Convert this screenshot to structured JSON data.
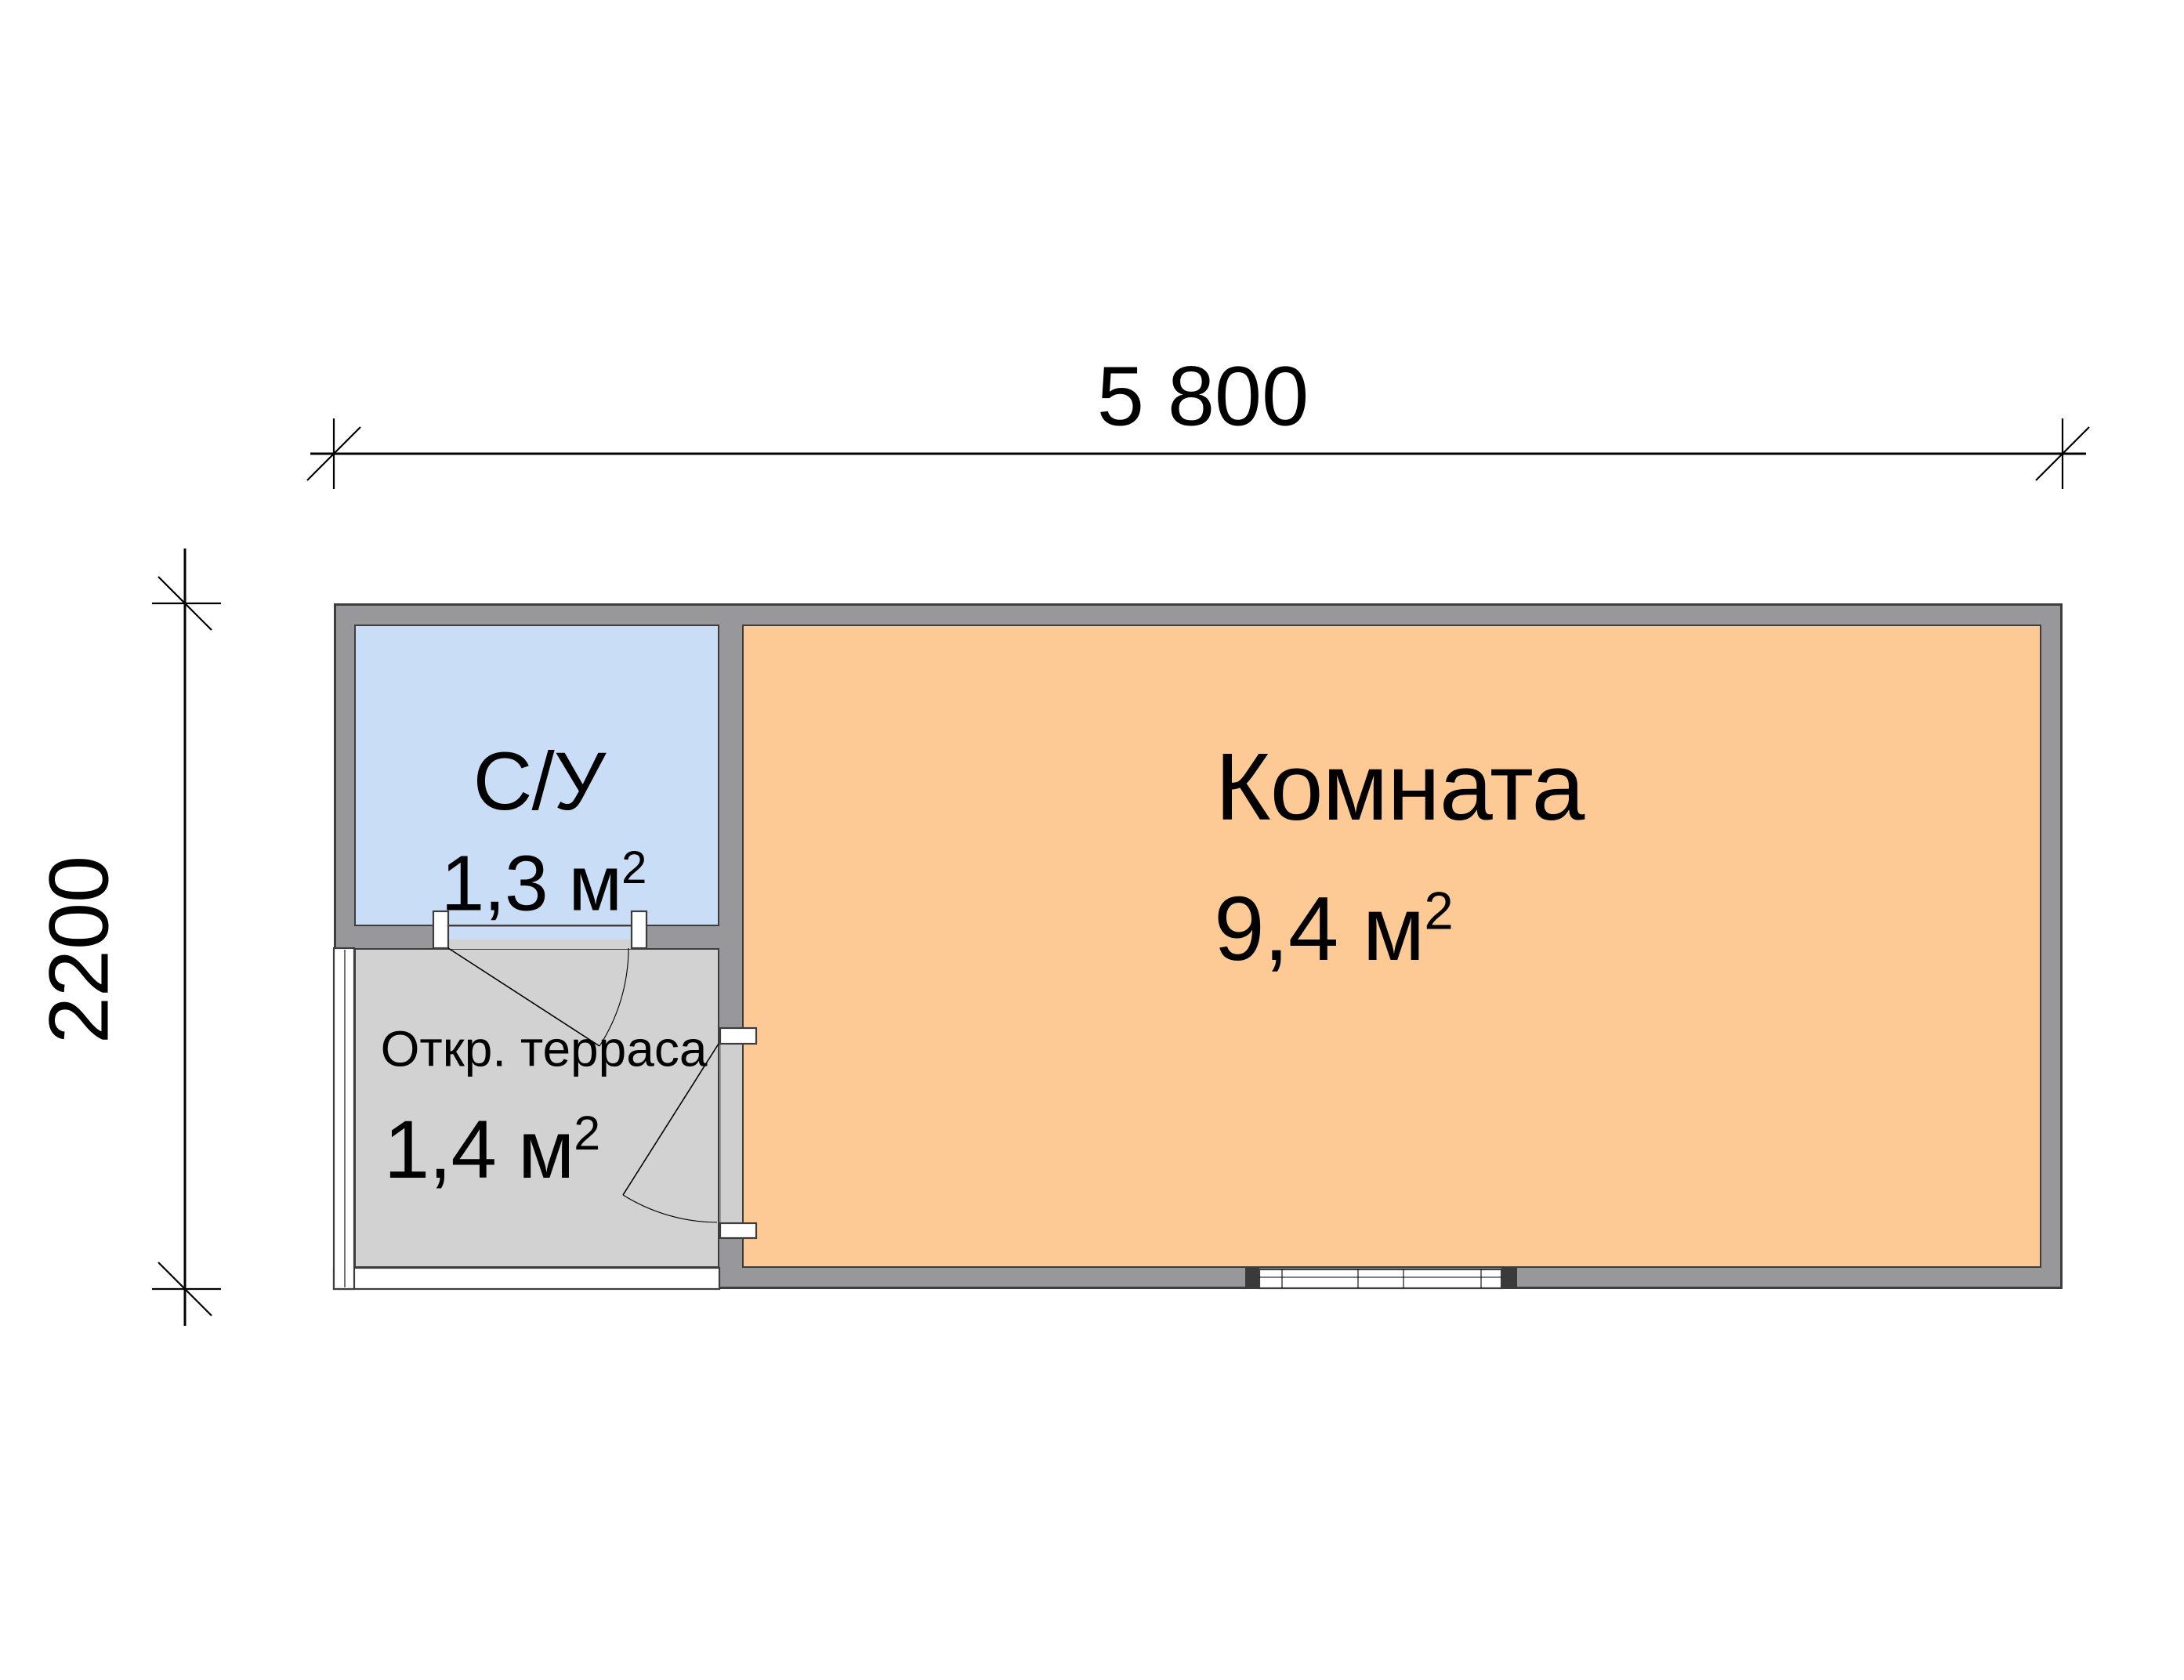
{
  "plan": {
    "dimensions": {
      "width_label": "5 800",
      "height_label": "2200"
    },
    "rooms": [
      {
        "id": "bathroom",
        "name": "С/У",
        "area": "1,3 м",
        "area_sup": "2"
      },
      {
        "id": "terrace",
        "name": "Откр. терраса",
        "area": "1,4 м",
        "area_sup": "2"
      },
      {
        "id": "main-room",
        "name": "Комната",
        "area": "9,4 м",
        "area_sup": "2"
      }
    ]
  },
  "colors": {
    "bathroom-fill": "#c9ddf6",
    "terrace-fill": "#d2d2d2",
    "room-fill": "#fdc995",
    "wall-fill": "#98979a",
    "door-gap": "#cfcfcf",
    "outline": "#3d3d3d",
    "line": "#000000",
    "page-bg": "#ffffff"
  }
}
